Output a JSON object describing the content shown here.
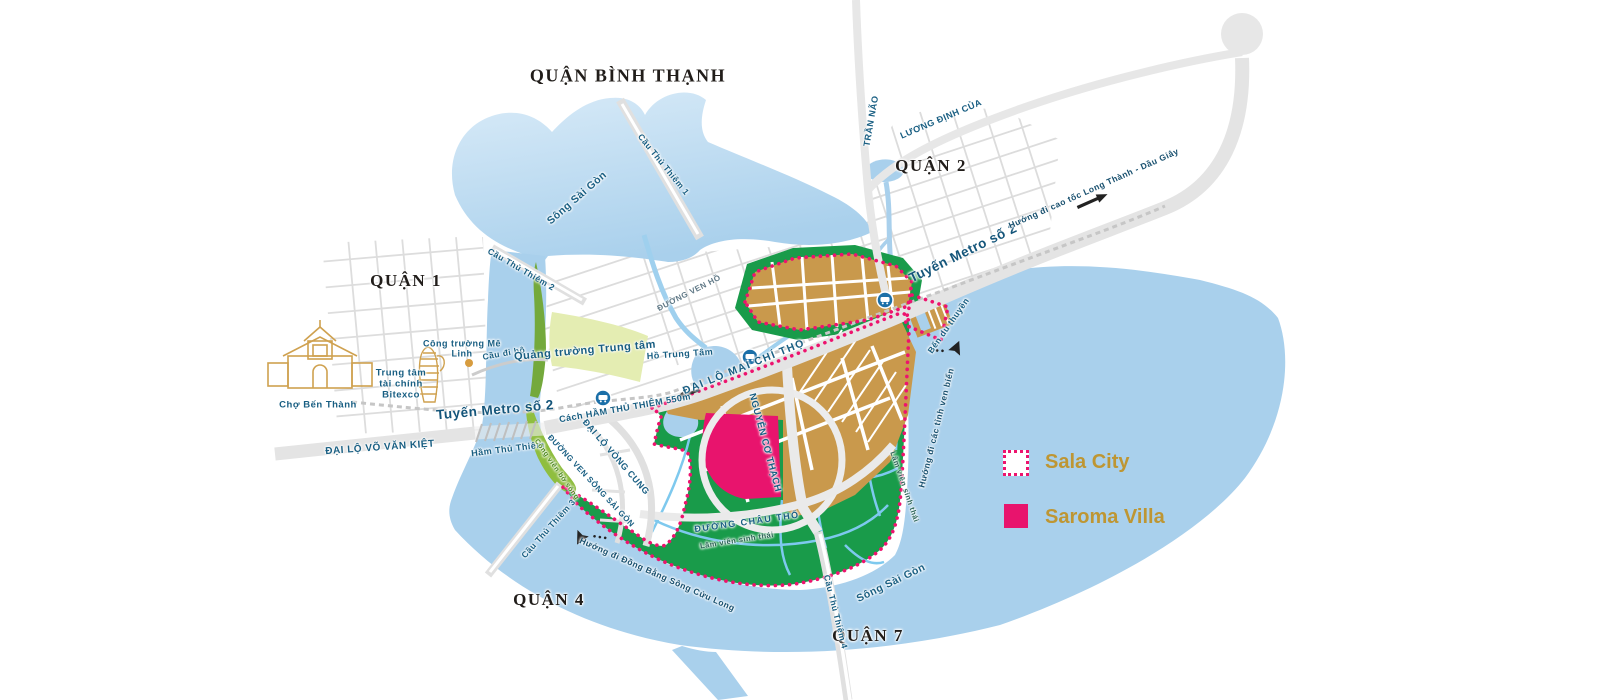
{
  "districts": {
    "binh_thanh": "QUẬN BÌNH THẠNH",
    "quan1": "QUẬN 1",
    "quan2": "QUẬN 2",
    "quan4": "QUẬN 4",
    "quan7": "QUẬN 7"
  },
  "rivers": {
    "saigon_top": "Sông Sài Gòn",
    "saigon_bottom": "Sông Sài Gòn"
  },
  "roads": {
    "vo_van_kiet": "ĐẠI LỘ VÕ VĂN KIỆT",
    "mai_chi_tho": "ĐẠI LỘ MAI CHÍ THỌ",
    "nguyen_co_thach": "NGUYỄN CƠ THẠCH",
    "vong_cung": "ĐẠI LỘ VÒNG CUNG",
    "ven_song_sai_gon": "ĐƯỜNG VEN SÔNG SÀI GÒN",
    "ven_ho": "ĐƯỜNG VEN HỒ",
    "chau_tho": "ĐƯỜNG CHÂU THỔ",
    "tran_nao": "TRẦN NÃO",
    "luong_dinh_cua": "LƯƠNG ĐỊNH CỦA"
  },
  "bridges_tunnels": {
    "thu_thiem_1": "Cầu Thủ Thiêm 1",
    "thu_thiem_2": "Cầu Thủ Thiêm 2",
    "thu_thiem_3": "Cầu Thủ Thiêm 3",
    "thu_thiem_4": "Cầu Thủ Thiêm 4",
    "cau_di_bo": "Cầu đi bộ",
    "ham_thu_thiem": "Hầm Thủ Thiêm",
    "ham_distance": "Cách HẦM THỦ THIÊM 550m"
  },
  "metro": {
    "label_west": "Tuyến Metro số 2",
    "label_east": "Tuyến Metro số 2"
  },
  "places": {
    "quang_truong": "Quảng trường Trung tâm",
    "ho_trung_tam": "Hồ Trung Tâm",
    "cho_ben_thanh": "Chợ Bến Thành",
    "bitexco": "Trung tâm tài chính Bitexco",
    "me_linh": "Công trường Mê Linh",
    "ben_du_thuyen": "Bến du thuyền",
    "cong_vien_bo_song": "Công viên bờ sông",
    "lam_vien_1": "Lâm viên sinh thái",
    "lam_vien_2": "Lâm viên sinh thái"
  },
  "directions": {
    "cao_toc": "Hướng đi cao tốc Long Thành - Dầu Giây",
    "mien_tay": "Hướng đi Đồng Bằng Sông Cửu Long",
    "ven_bien": "Hướng đi các tỉnh ven biển"
  },
  "legend": {
    "sala_city": "Sala City",
    "saroma_villa": "Saroma Villa"
  },
  "colors": {
    "sala_boundary_pink": "#ED136E",
    "saroma_fill_pink": "#E8146D",
    "legend_text_gold": "#BE9633",
    "river_blue": "#A9D0EC",
    "creek_blue": "#7EC9EE",
    "park_green": "#199B4A",
    "riverside_park_green": "#8FBE3F",
    "plaza_pale_green": "#E4EDB2",
    "urban_gold": "#C9994C",
    "road_gray": "#E4E4E4",
    "metro_icon_blue": "#1B6FA8",
    "label_navy": "#185E82"
  }
}
